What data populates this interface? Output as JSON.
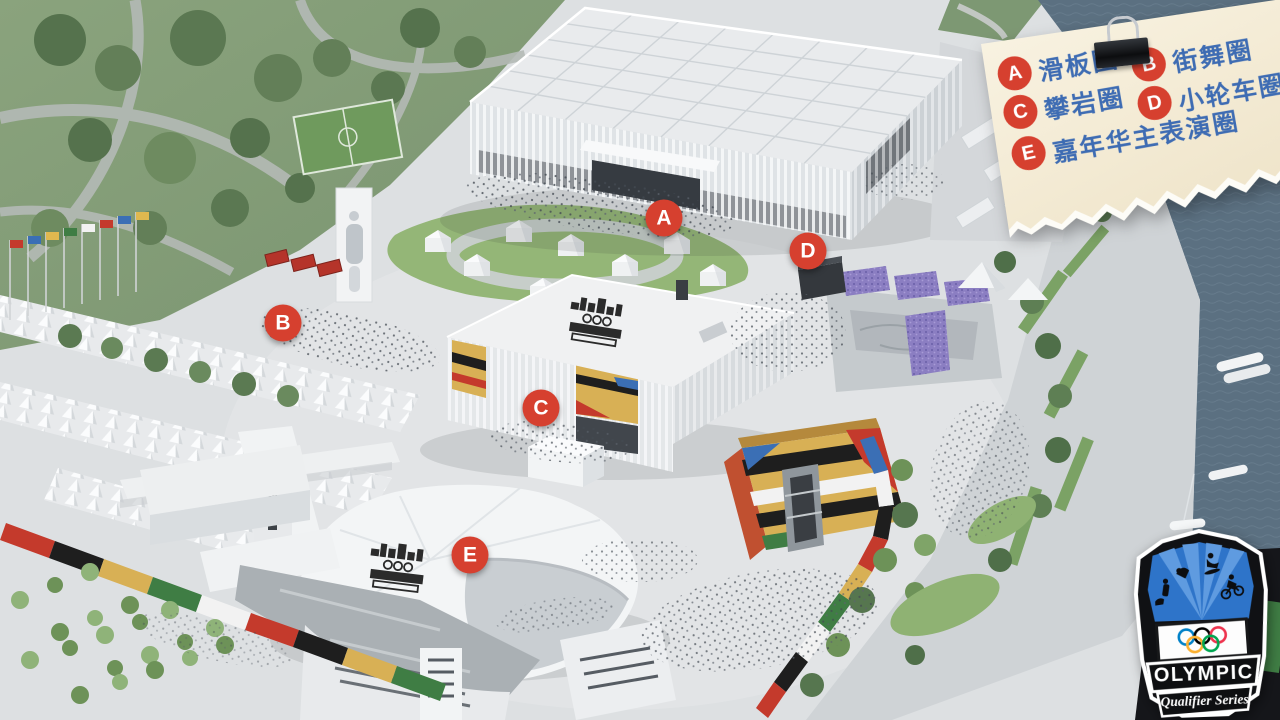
{
  "legend": {
    "items": [
      {
        "letter": "A",
        "label": "滑板圈"
      },
      {
        "letter": "B",
        "label": "街舞圈"
      },
      {
        "letter": "C",
        "label": "攀岩圈"
      },
      {
        "letter": "D",
        "label": "小轮车圈"
      },
      {
        "letter": "E",
        "label": "嘉年华主表演圈"
      }
    ]
  },
  "markers": {
    "a": "A",
    "b": "B",
    "c": "C",
    "d": "D",
    "e": "E"
  },
  "logo": {
    "title": "OLYMPIC",
    "subtitle": "Qualifier Series"
  },
  "colors": {
    "marker_red": "#d6402f",
    "legend_blue": "#3e6cb3",
    "note_paper": "#f3ead3",
    "water": "#5e7383",
    "lawn_green": "#94b677",
    "mural_gold": "#d8b055",
    "stand_purple": "#8b7ec2",
    "ring_blue": "#0081c8",
    "ring_yellow": "#fcb131",
    "ring_black": "#000000",
    "ring_green": "#00a651",
    "ring_red": "#ee334e"
  }
}
